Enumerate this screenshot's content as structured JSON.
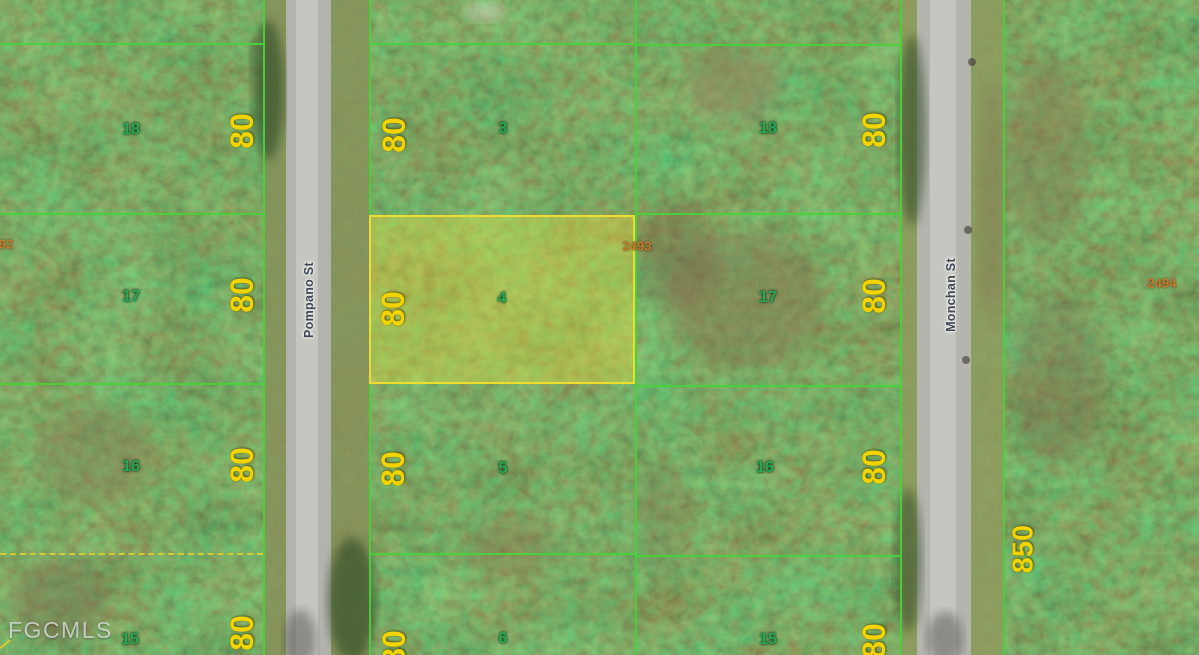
{
  "map": {
    "description": "Aerial plat map of wooded residential lots with subject lot highlighted",
    "watermark": "FGCMLS",
    "streets": {
      "left": "Pompano St",
      "right": "Monchan St"
    },
    "parcel_labels": {
      "subject_block": "2493",
      "right_block": "2494",
      "left_edge_partial": "92",
      "bottom_right_depth": "850"
    },
    "columns": {
      "left": {
        "lots": [
          {
            "num": "18",
            "dim": "80"
          },
          {
            "num": "17",
            "dim": "80"
          },
          {
            "num": "16",
            "dim": "80"
          },
          {
            "num": "15",
            "dim": "80"
          }
        ]
      },
      "middle": {
        "lots": [
          {
            "num": "3",
            "dim": "80"
          },
          {
            "num": "4",
            "dim": "80",
            "highlighted": true
          },
          {
            "num": "5",
            "dim": "80"
          },
          {
            "num": "6",
            "dim": "80"
          }
        ]
      },
      "right": {
        "lots": [
          {
            "num": "18",
            "dim": "80"
          },
          {
            "num": "17",
            "dim": "80"
          },
          {
            "num": "16",
            "dim": "80"
          },
          {
            "num": "15",
            "dim": "80"
          }
        ]
      }
    },
    "colors": {
      "lot_line": "#48d23a",
      "highlight_border": "#eedd2e",
      "highlight_fill": "rgba(230,220,62,0.40)",
      "dimension_text": "#f2d400",
      "lot_number_text": "#27a856",
      "parcel_id_text": "#c8792b",
      "street_text": "#3e4657",
      "road_pavement": "#b4b5af"
    }
  }
}
